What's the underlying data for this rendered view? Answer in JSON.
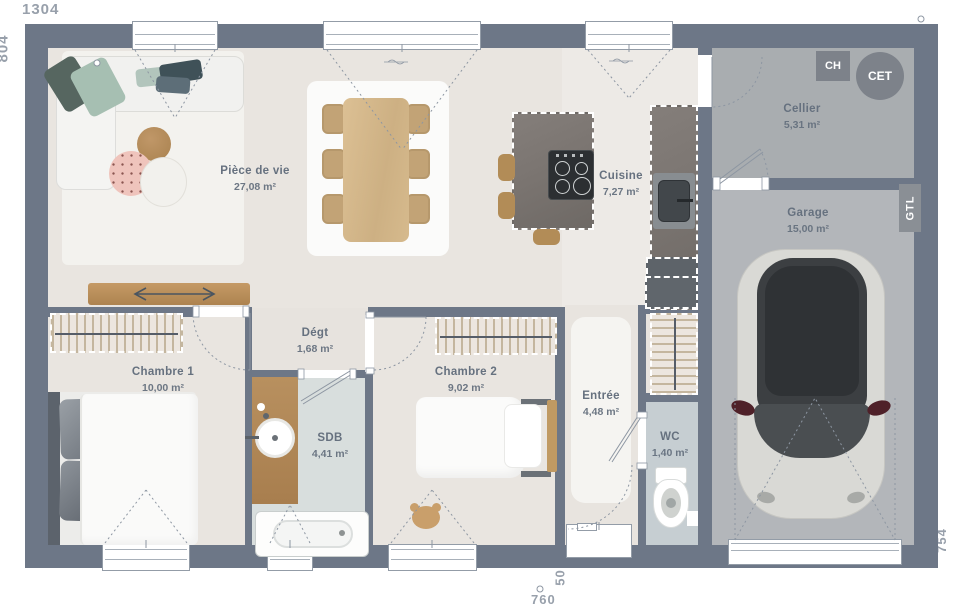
{
  "plan_title": "Plan de maison plain-pied 3 chambres avec garage",
  "dimensions": {
    "top_width": "1304",
    "left_height": "804",
    "right_height": "754",
    "garage_width": "544",
    "bottom_width": "760",
    "entry_offset": "50"
  },
  "rooms": [
    {
      "id": "piece-de-vie",
      "name": "Pièce de vie",
      "area": "27,08 m²"
    },
    {
      "id": "cuisine",
      "name": "Cuisine",
      "area": "7,27 m²"
    },
    {
      "id": "cellier",
      "name": "Cellier",
      "area": "5,31 m²"
    },
    {
      "id": "garage",
      "name": "Garage",
      "area": "15,00 m²"
    },
    {
      "id": "chambre-1",
      "name": "Chambre 1",
      "area": "10,00 m²"
    },
    {
      "id": "chambre-2",
      "name": "Chambre 2",
      "area": "9,02 m²"
    },
    {
      "id": "degagement",
      "name": "Dégt",
      "area": "1,68 m²"
    },
    {
      "id": "sdb",
      "name": "SDB",
      "area": "4,41 m²"
    },
    {
      "id": "entree",
      "name": "Entrée",
      "area": "4,48 m²"
    },
    {
      "id": "wc",
      "name": "WC",
      "area": "1,40 m²"
    }
  ],
  "equipment": [
    {
      "id": "ch",
      "label": "CH"
    },
    {
      "id": "cet",
      "label": "CET"
    },
    {
      "id": "gtl",
      "label": "GTL"
    }
  ],
  "colors": {
    "wall": "#6d7787",
    "floor_main": "#e9e5e0",
    "floor_kitchen": "#edeae6",
    "floor_sdb": "#d8dedd",
    "floor_wc": "#c6ced2",
    "floor_cellier": "#a9adb0",
    "floor_garage": "#b3b6ba",
    "label_text": "#66717f",
    "dimension_text": "#98a0ab",
    "wood": "#b8905f",
    "stone": "#7b7571"
  }
}
